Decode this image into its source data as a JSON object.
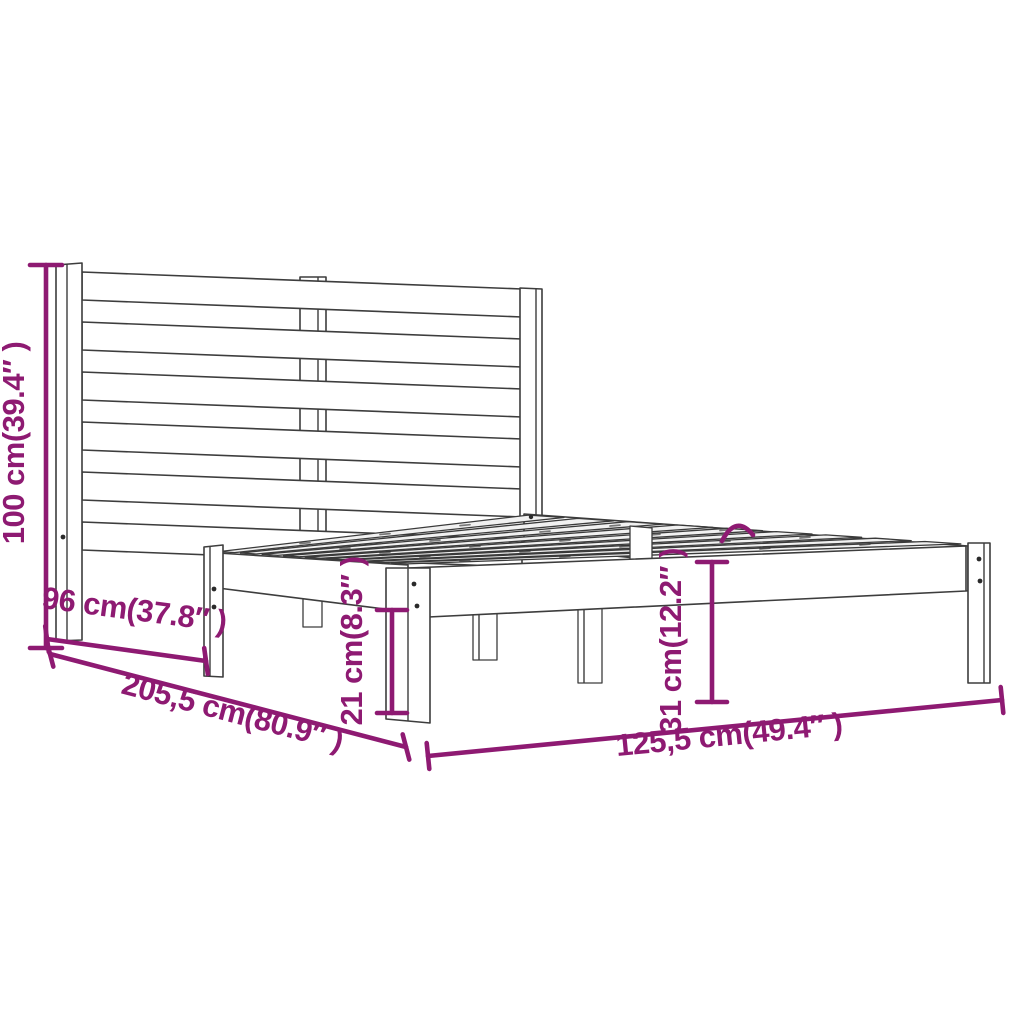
{
  "diagram": {
    "kind": "bed-frame-dimension-diagram",
    "background_color": "#ffffff",
    "line_color": "#3d3d3d",
    "accent_color": "#8e1a72",
    "dimensions": {
      "headboard_height": "100 cm(39.4″ )",
      "side_span": "96 cm(37.8″ )",
      "total_length": "205,5 cm(80.9″ )",
      "clearance_height": "21 cm(8.3″ )",
      "platform_height": "31 cm(12.2″ )",
      "total_width": "125,5 cm(49.4″ )"
    }
  }
}
